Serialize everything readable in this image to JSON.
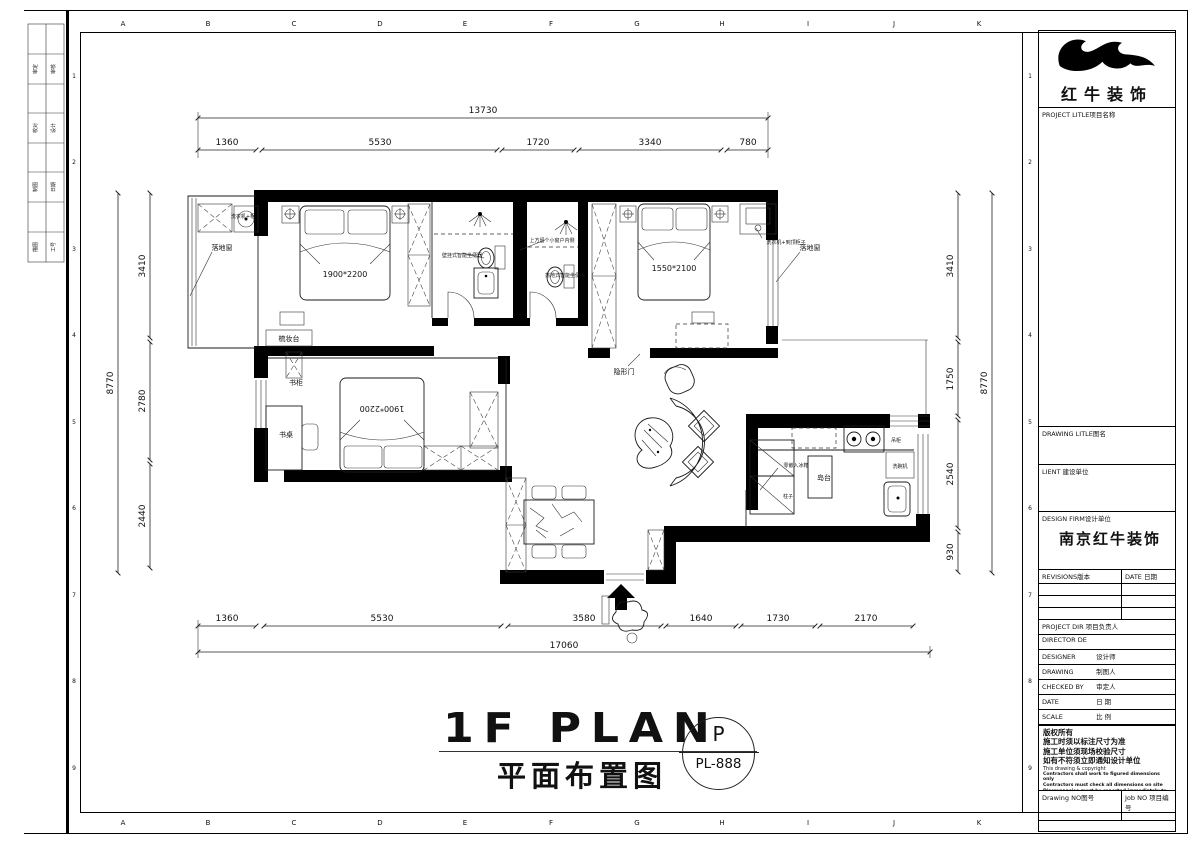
{
  "brand": {
    "name": "红牛装饰"
  },
  "sheet": {
    "letters": [
      "A",
      "B",
      "C",
      "D",
      "E",
      "F",
      "G",
      "H",
      "I",
      "J",
      "K"
    ],
    "numbers": [
      "1",
      "2",
      "3",
      "4",
      "5",
      "6",
      "7",
      "8",
      "9"
    ],
    "sign_block": {
      "rows": [
        [
          "审定",
          "审核"
        ],
        [
          "校对",
          "设计"
        ],
        [
          "制图",
          "日期"
        ],
        [
          "描图",
          "工号"
        ]
      ]
    }
  },
  "title_block": {
    "project_title": "PROJECT LITLE项目名称",
    "drawing_title": "DRAWING LITLE图名",
    "client": "LIENT 建设单位",
    "design_firm": "DESIGN FIRM设计单位",
    "design_firm_value": "南京红牛装饰",
    "revisions": "REVISIONS版本",
    "revisions_date": "DATE 日期",
    "project_dir": "PROJECT DIR 项目负责人",
    "director": "DIRECTOR DE",
    "designer_en": "DESIGNER",
    "designer_cn": "设计师",
    "drawing_en": "DRAWING",
    "drawing_cn": "制图人",
    "checked_en": "CHECKED BY",
    "checked_cn": "审定人",
    "date_en": "DATE",
    "date_cn": "日 期",
    "scale_en": "SCALE",
    "scale_cn": "比 例",
    "copyright_title": "版权所有",
    "copyright_line1": "施工时须以标注尺寸为准",
    "copyright_line2": "施工单位须现场校验尺寸",
    "copyright_line3": "如有不符须立即通知设计单位",
    "copyright_en": "This drawing & copyright",
    "copyright_en1": "Contractors shall work to figured dimensions only",
    "copyright_en2": "Contractors must check all dimensions on site",
    "copyright_en3": "Discrepancies must be reported immediately to architects",
    "drawing_no": "Drawing NO图号",
    "job_no": "Job NO 项目编号"
  },
  "footer": {
    "title_en": "1F PLAN",
    "title_cn": "平面布置图",
    "stamp_top": "P",
    "stamp_code": "PL-888"
  },
  "dimensions": {
    "top_total": "13730",
    "top_segments": [
      "1360",
      "5530",
      "1720",
      "3340",
      "780"
    ],
    "bottom_segments": [
      "1360",
      "5530",
      "3580",
      "1640",
      "1730",
      "2170"
    ],
    "bottom_total": "17060",
    "left_total": "8770",
    "left_segments": [
      "3410",
      "2780",
      "2440"
    ],
    "right_segments": [
      "3410",
      "1750",
      "2540",
      "930"
    ],
    "right_total": "8770"
  },
  "plan": {
    "labels": {
      "balcony_window_left": "落地窗",
      "washer_left": "洗衣机+柜",
      "bed1_size": "1900*2200",
      "dresser": "梳妆台",
      "bookcase": "书柜",
      "desk": "书桌",
      "bed2_size": "1900*2200",
      "wc1": "壁挂式智能坐便器",
      "window_note": "上方留个小窗户内侧",
      "wc2": "落地式智能坐便器",
      "hidden_door": "隐形门",
      "bed3_size": "1550*2100",
      "washer_right": "洗衣机+到顶柜子",
      "balcony_window_right": "落地窗",
      "hang_cabinet": "吊柜",
      "dishwasher": "洗碗机",
      "island": "岛台",
      "fridge": "零嵌入冰箱",
      "column": "柱子"
    }
  }
}
